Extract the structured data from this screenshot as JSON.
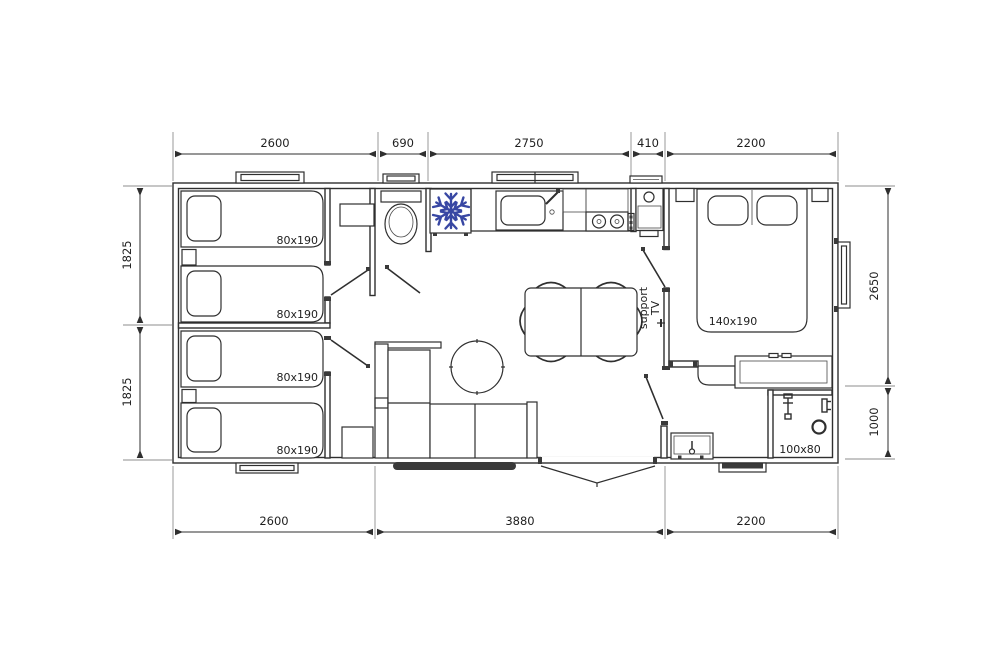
{
  "colors": {
    "line": "#2f2f2f",
    "snowflake": "#3847a3",
    "dark_fill": "#3a3a3a",
    "dim_text": "#1f1f1f"
  },
  "dims": {
    "top": [
      "2600",
      "690",
      "2750",
      "410",
      "2200"
    ],
    "bottom": [
      "2600",
      "3880",
      "2200"
    ],
    "left": [
      "1825",
      "1825"
    ],
    "right": [
      "2650",
      "1000"
    ]
  },
  "rooms": {
    "single_bed_labels": [
      "80x190",
      "80x190",
      "80x190",
      "80x190"
    ],
    "double_bed_label": "140x190",
    "shower_label": "100x80",
    "tv_support": {
      "line1": "support",
      "line2": "TV"
    }
  }
}
